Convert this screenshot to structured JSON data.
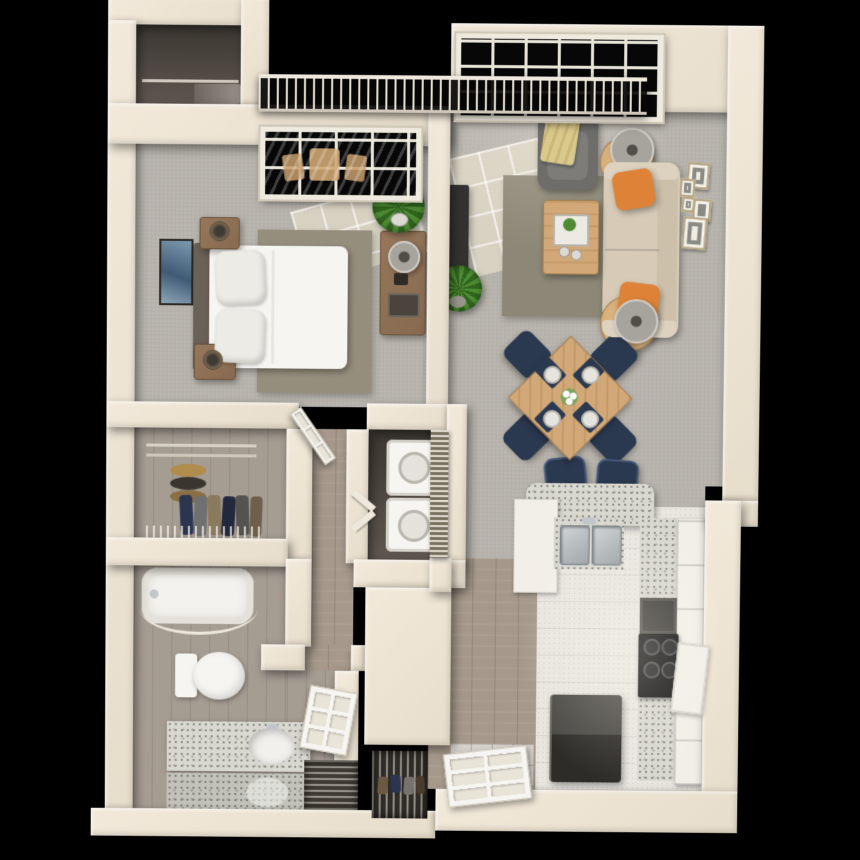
{
  "scene": {
    "kind": "3d-apartment-floor-plan-render",
    "view": "top-down",
    "background": "#000000",
    "units_note": "one-bedroom one-bath apartment with balcony"
  },
  "palette": {
    "bg": "#000000",
    "wall": "#f2e9da",
    "carpet": "#b6b2ab",
    "wood": "#a6998b",
    "bath-wood": "#a59c92",
    "tile": "#d7d3cc",
    "kitchen-floor": "#e9e6df",
    "granite": "#d8d7d0",
    "granite-dot": "#8e8e88",
    "cabinet": "#f2efe8",
    "white": "#f7f5f1",
    "steel": "#b6babe",
    "dark-appliance": "#35332f",
    "navy": "#2b3950",
    "orange": "#dd8236",
    "sofa": "#d7cbb8",
    "chair-gray": "#6e6d6a",
    "throw": "#d9c98d",
    "table-wood": "#d2a878",
    "brown": "#876a50",
    "rug-living": "#8c8776",
    "rug-bedroom": "#968e7d",
    "plant": "#4d8c33",
    "plant-dark": "#31661f",
    "closet-floor": "#5f5850",
    "glass": "#070707",
    "railing-light": "#e7e1d4"
  },
  "rooms": [
    {
      "id": "balcony",
      "label": "Balcony",
      "items": [
        "railing",
        "patio bistro set seen through window"
      ]
    },
    {
      "id": "bedroom",
      "label": "Bedroom",
      "items": [
        "bed with white duvet",
        "headboard",
        "2 pillows",
        "2 nightstands",
        "2 bedside lamps",
        "area rug",
        "wall art",
        "dresser with lamp and tray",
        "potted plant",
        "window to balcony",
        "reach-in closet nook"
      ]
    },
    {
      "id": "living-room",
      "label": "Living Room",
      "items": [
        "picture window",
        "gray armchair",
        "gold throw blanket",
        "beige sofa",
        "2 orange accent pillows",
        "2 round side tables",
        "2 drum lamps",
        "coffee table with tray and plant",
        "area rug",
        "tv console",
        "tv",
        "potted plant",
        "gallery of 5 wall frames"
      ]
    },
    {
      "id": "dining-area",
      "label": "Dining Area",
      "items": [
        "square wood table rotated 45deg",
        "4 navy chairs",
        "4 navy placemats with white plates",
        "white flower centerpiece"
      ]
    },
    {
      "id": "kitchen",
      "label": "Kitchen",
      "items": [
        "granite breakfast bar",
        "2 navy bar stools",
        "double stainless sink with faucet",
        "granite counters",
        "white cabinets",
        "range hood",
        "black gas stove",
        "open cabinet door",
        "dark refrigerator"
      ]
    },
    {
      "id": "walk-in-closet",
      "label": "Walk-in Closet",
      "items": [
        "closet rods",
        "stacked hats",
        "hanging clothes",
        "wire shelving"
      ]
    },
    {
      "id": "laundry-closet",
      "label": "Laundry Closet",
      "items": [
        "stacked washer and dryer",
        "louvered bifold doors"
      ]
    },
    {
      "id": "hallway",
      "label": "Hallway",
      "items": [
        "wood flooring",
        "open bedroom door",
        "open bathroom door"
      ]
    },
    {
      "id": "bathroom",
      "label": "Bathroom",
      "items": [
        "bathtub with curved shower rod",
        "toilet",
        "granite vanity with oval sink",
        "mirror reflection"
      ]
    },
    {
      "id": "entry",
      "label": "Entry",
      "items": [
        "paneled front door",
        "tile landing",
        "louvered utility closet",
        "shoe closet with wire shelves"
      ]
    }
  ]
}
